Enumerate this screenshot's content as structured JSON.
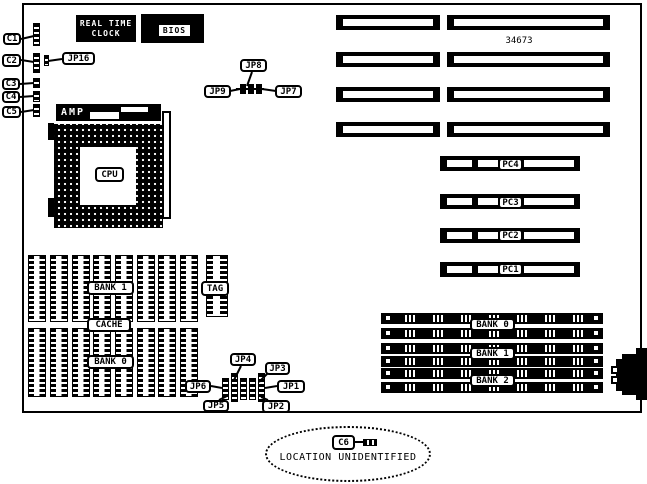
{
  "diagram": {
    "part_number": "34673",
    "ellipse_text": "LOCATION UNIDENTIFIED"
  },
  "boxes": {
    "rtc_line1": "REAL TIME",
    "rtc_line2": "CLOCK",
    "bios": "BIOS",
    "amp": "AMP"
  },
  "callouts": {
    "c1": "C1",
    "c2": "C2",
    "c3": "C3",
    "c4": "C4",
    "c5": "C5",
    "c6": "C6",
    "jp16": "JP16",
    "jp8": "JP8",
    "jp9": "JP9",
    "jp7": "JP7",
    "jp1": "JP1",
    "jp2": "JP2",
    "jp3": "JP3",
    "jp4": "JP4",
    "jp5": "JP5",
    "jp6": "JP6",
    "cpu": "CPU",
    "cache_bank1": "BANK 1",
    "cache_label": "CACHE",
    "cache_bank0": "BANK 0",
    "tag": "TAG",
    "pc_slots": [
      "PC4",
      "PC3",
      "PC2",
      "PC1"
    ],
    "simm_banks": [
      "BANK 0",
      "BANK 1",
      "BANK 2"
    ]
  }
}
